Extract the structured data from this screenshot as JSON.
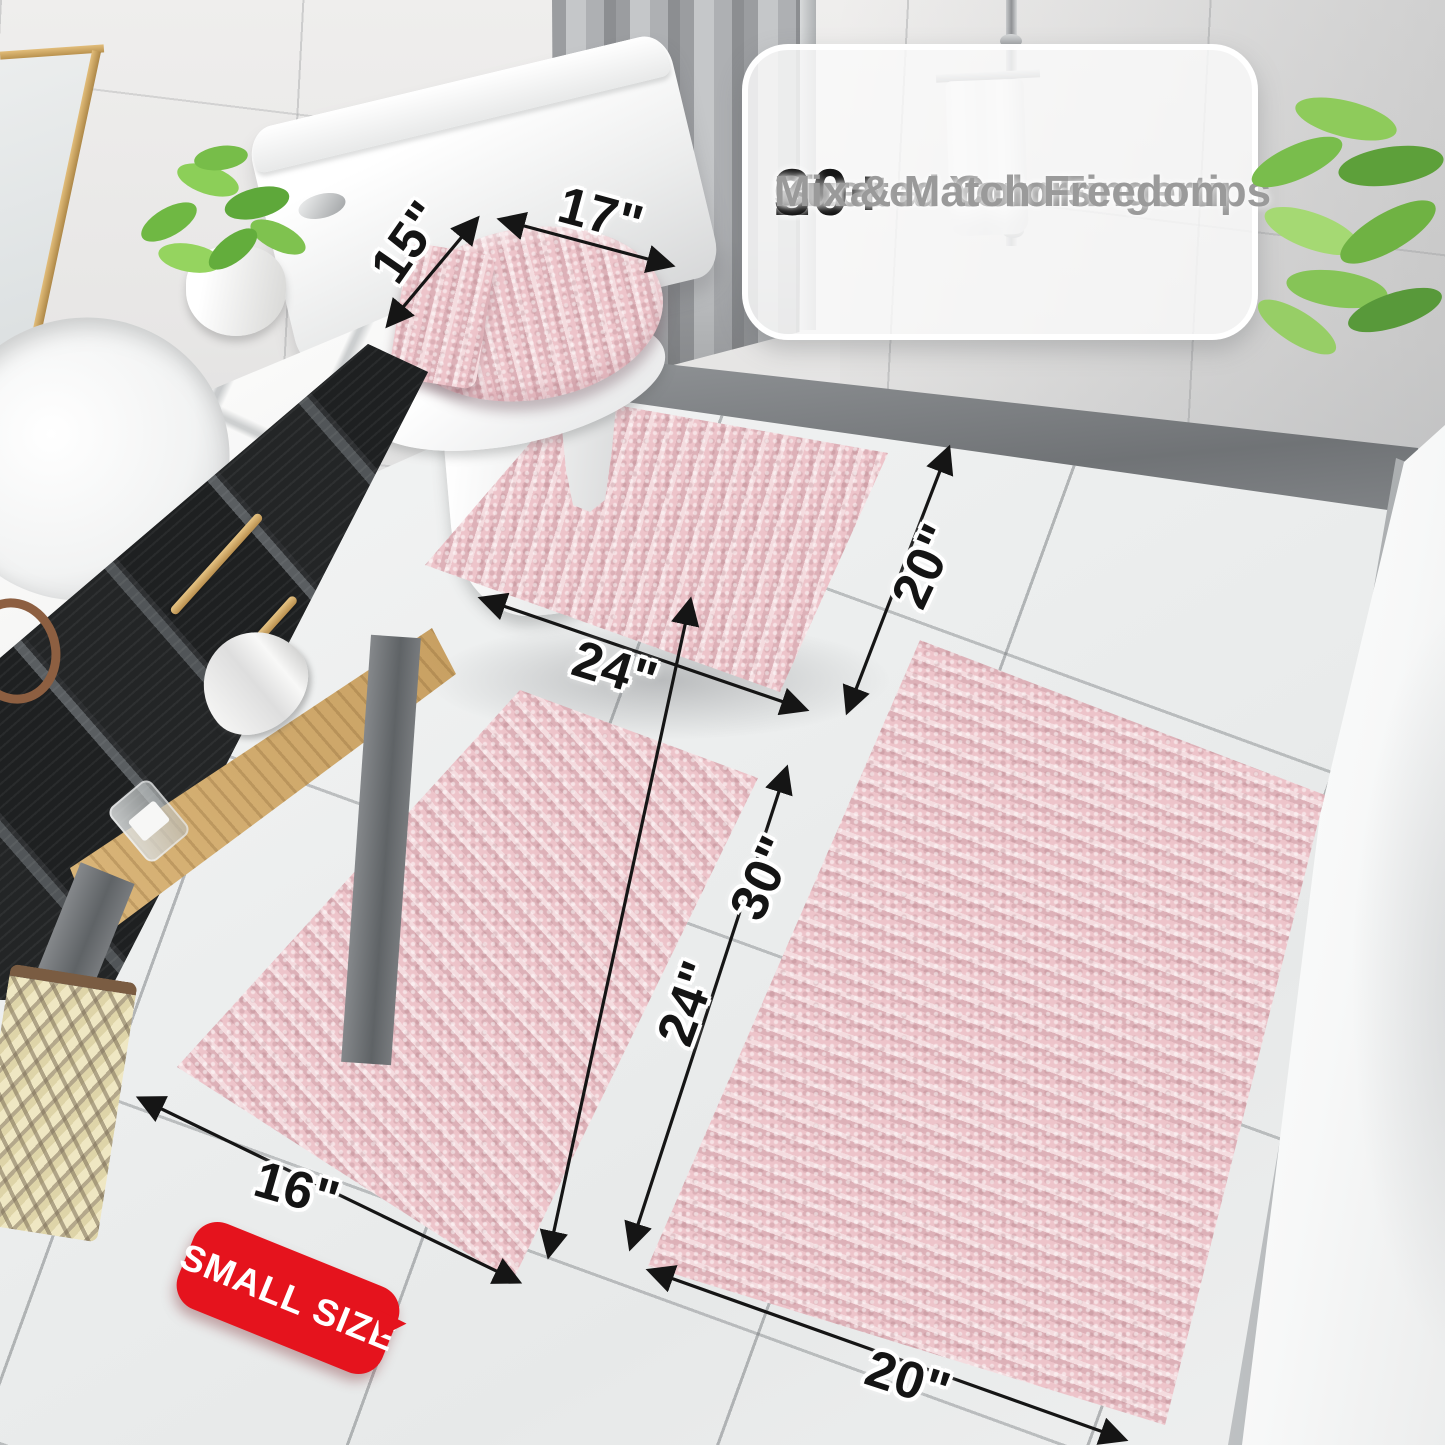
{
  "product_callout": {
    "checkmark": "✔",
    "features": [
      {
        "value": "20+",
        "label": "Sizes at Your Fingertips"
      },
      {
        "value": "30+",
        "label": "Curated Colors"
      },
      {
        "value": "",
        "label": "Mix & Match Freedom"
      }
    ]
  },
  "dimensions": {
    "lid_length": "17\"",
    "lid_width": "15\"",
    "contour_width": "24\"",
    "contour_depth": "20\"",
    "small_rug_width": "16\"",
    "small_rug_length": "24\"",
    "large_rug_length": "30\"",
    "large_rug_width": "20\""
  },
  "badge": {
    "text": "SMALL SIZE"
  },
  "colors": {
    "rug_pink": "#edc4ca",
    "badge_red": "#e5131d",
    "dimension_ink": "#141414",
    "floor_tile": "#eceeee",
    "wall_tile": "#e7e6e5",
    "gold_accent": "#c9a35f"
  }
}
